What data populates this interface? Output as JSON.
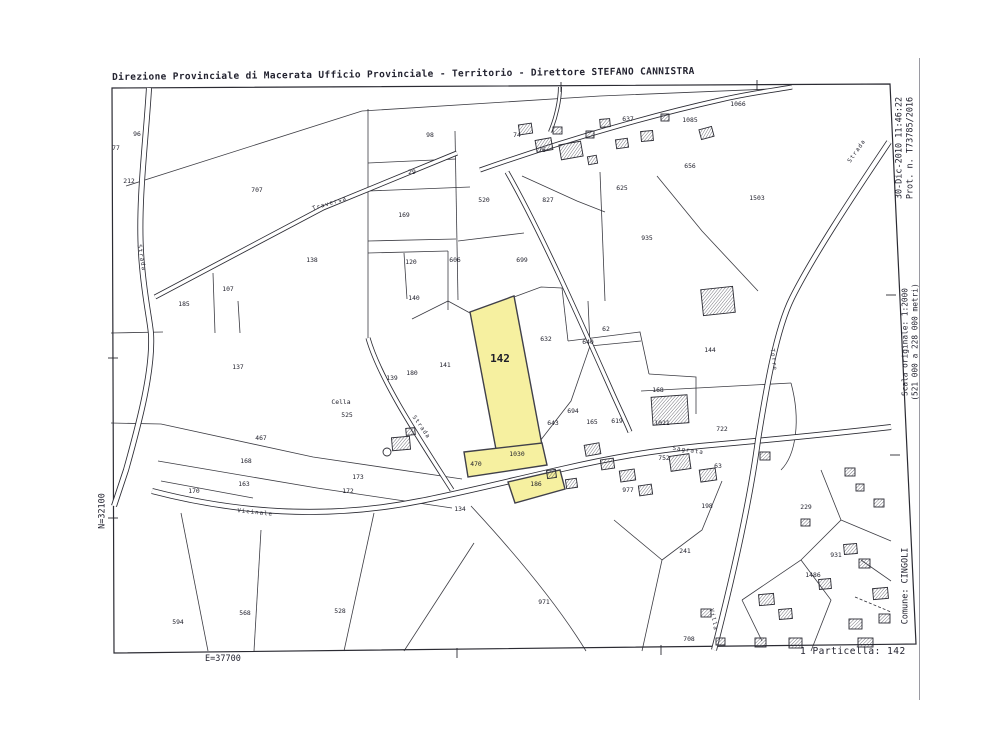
{
  "header": {
    "title": "Direzione Provinciale di Macerata  Ufficio Provinciale - Territorio - Direttore STEFANO CANNISTRA"
  },
  "margins": {
    "right_top_line1": "30-Dic-2010 11:46:22",
    "right_top_line2": "Prot. n. T73785/2016",
    "scale_line1": "Scala originale: 1:2000",
    "scale_line2": "(521 000 a 228 000 metri)",
    "comune": "Comune: CINGOLI",
    "north": "N=32100",
    "east": "E=37700",
    "particella": "1 Particella: 142"
  },
  "map": {
    "line_color": "#2b2b33",
    "highlight_color": "#f6f0a0",
    "highlight_stroke": "#40404a",
    "frame": [
      [
        112,
        88
      ],
      [
        890,
        84
      ],
      [
        916,
        644
      ],
      [
        114,
        653
      ]
    ],
    "highlights": [
      {
        "name": "parcel-142",
        "points": [
          [
            470,
            312
          ],
          [
            514,
            296
          ],
          [
            542,
            445
          ],
          [
            498,
            460
          ]
        ]
      },
      {
        "name": "parcel-1030",
        "points": [
          [
            464,
            452
          ],
          [
            542,
            443
          ],
          [
            547,
            465
          ],
          [
            468,
            477
          ]
        ]
      },
      {
        "name": "parcel-186",
        "points": [
          [
            508,
            482
          ],
          [
            560,
            470
          ],
          [
            565,
            489
          ],
          [
            515,
            503
          ]
        ]
      }
    ],
    "roads": [
      {
        "d": "M149,88 C146,140 138,200 141,252 C143,290 150,320 151,334 C153,370 140,420 126,470 L114,506",
        "w": 6
      },
      {
        "d": "M457,153 L323,208 L155,297",
        "w": 5
      },
      {
        "d": "M480,170 C560,142 640,118 720,100 C750,93 770,91 792,87",
        "w": 5
      },
      {
        "d": "M560,87 C560,100 556,118 550,132",
        "w": 4
      },
      {
        "d": "M368,338 C380,380 420,440 452,490",
        "w": 5
      },
      {
        "d": "M507,172 C540,230 580,320 612,392 C620,410 625,420 630,432",
        "w": 5
      },
      {
        "d": "M152,491 C240,514 330,519 420,501 C465,492 505,482 562,469 C610,458 650,451 700,446 C780,439 830,434 891,427",
        "w": 6
      },
      {
        "d": "M889,142 C850,200 812,258 792,298 C776,330 766,390 758,440 C750,500 732,580 714,650",
        "w": 6
      }
    ],
    "boundaries": [
      "M126,186 L362,111",
      "M362,111 L600,96 L770,89",
      "M368,109 L368,338",
      "M368,163 L456,159",
      "M368,191 L470,187",
      "M455,131 L458,300",
      "M368,241 L456,239",
      "M458,241 L524,233",
      "M213,273 L215,333",
      "M404,253 L407,299",
      "M368,253 L448,251",
      "M111,333 L163,332",
      "M111,423 L161,424",
      "M161,424 L313,457 L462,479",
      "M158,461 L317,488 L452,508",
      "M161,481 L253,498",
      "M181,513 L208,651",
      "M261,530 L254,651",
      "M374,513 L344,651",
      "M474,543 L404,651",
      "M471,506 C521,560 561,610 586,651",
      "M238,301 L240,333",
      "M412,319 L448,301",
      "M448,251 L448,310",
      "M448,301 L470,313",
      "M514,297 L541,287 L562,288",
      "M562,288 L568,341",
      "M540,441 L571,401 L590,346 L588,301",
      "M568,341 L640,332 L649,374",
      "M590,346 L641,341",
      "M600,172 L605,301",
      "M649,374 L696,377 L696,414",
      "M641,391 L791,383",
      "M791,383 C801,420 796,455 781,470",
      "M614,520 L662,560 L642,651",
      "M722,481 L702,530 L662,560",
      "M821,470 L841,520 L801,560 L742,600",
      "M841,520 L891,541",
      "M801,560 L831,600 L811,651",
      "M742,600 L762,641",
      "M861,560 L891,581",
      "M522,176 L577,201 L605,212",
      "M657,176 L702,231 L758,291"
    ],
    "dashed": [
      "M855,597 L891,612"
    ],
    "buildings": [
      [
        519,
        124,
        13,
        10,
        -8
      ],
      [
        536,
        139,
        16,
        12,
        -10
      ],
      [
        553,
        127,
        9,
        7,
        0
      ],
      [
        560,
        143,
        22,
        15,
        -10
      ],
      [
        586,
        131,
        8,
        7,
        0
      ],
      [
        600,
        119,
        10,
        8,
        -5
      ],
      [
        616,
        139,
        12,
        9,
        -8
      ],
      [
        641,
        131,
        12,
        10,
        -5
      ],
      [
        661,
        114,
        8,
        7,
        0
      ],
      [
        588,
        156,
        9,
        8,
        -10
      ],
      [
        700,
        128,
        13,
        10,
        -15
      ],
      [
        702,
        288,
        32,
        26,
        -6
      ],
      [
        652,
        396,
        36,
        28,
        -4
      ],
      [
        670,
        455,
        20,
        15,
        -8
      ],
      [
        700,
        469,
        16,
        12,
        -8
      ],
      [
        585,
        444,
        15,
        11,
        -10
      ],
      [
        601,
        459,
        13,
        10,
        -8
      ],
      [
        620,
        470,
        15,
        11,
        -8
      ],
      [
        639,
        485,
        13,
        10,
        -8
      ],
      [
        566,
        479,
        11,
        9,
        -8
      ],
      [
        547,
        470,
        9,
        8,
        -8
      ],
      [
        392,
        437,
        18,
        13,
        -5
      ],
      [
        406,
        428,
        9,
        7,
        -5
      ],
      [
        760,
        452,
        10,
        8,
        0
      ],
      [
        845,
        468,
        10,
        8,
        0
      ],
      [
        856,
        484,
        8,
        7,
        0
      ],
      [
        874,
        499,
        10,
        8,
        0
      ],
      [
        801,
        519,
        9,
        7,
        0
      ],
      [
        759,
        594,
        15,
        11,
        -5
      ],
      [
        779,
        609,
        13,
        10,
        -5
      ],
      [
        819,
        579,
        12,
        10,
        -5
      ],
      [
        844,
        544,
        13,
        10,
        -5
      ],
      [
        859,
        559,
        11,
        9,
        0
      ],
      [
        873,
        588,
        15,
        11,
        -5
      ],
      [
        849,
        619,
        13,
        10,
        0
      ],
      [
        879,
        614,
        11,
        9,
        0
      ],
      [
        755,
        638,
        11,
        9,
        0
      ],
      [
        789,
        638,
        13,
        10,
        0
      ],
      [
        701,
        609,
        10,
        8,
        0
      ],
      [
        716,
        638,
        9,
        7,
        0
      ],
      [
        858,
        638,
        15,
        9,
        0
      ]
    ],
    "wells": [
      [
        387,
        452,
        4
      ]
    ],
    "ticks": [
      [
        561,
        82,
        561,
        92
      ],
      [
        757,
        80,
        757,
        90
      ],
      [
        457,
        648,
        457,
        658
      ],
      [
        661,
        645,
        661,
        655
      ],
      [
        108,
        358,
        118,
        358
      ],
      [
        108,
        518,
        118,
        518
      ],
      [
        886,
        295,
        896,
        295
      ],
      [
        890,
        455,
        900,
        455
      ]
    ],
    "labels": [
      {
        "t": "77",
        "x": 116,
        "y": 150
      },
      {
        "t": "96",
        "x": 137,
        "y": 136
      },
      {
        "t": "212",
        "x": 129,
        "y": 183
      },
      {
        "t": "707",
        "x": 257,
        "y": 192
      },
      {
        "t": "98",
        "x": 430,
        "y": 137
      },
      {
        "t": "29",
        "x": 412,
        "y": 174
      },
      {
        "t": "169",
        "x": 404,
        "y": 217
      },
      {
        "t": "520",
        "x": 484,
        "y": 202
      },
      {
        "t": "138",
        "x": 312,
        "y": 262
      },
      {
        "t": "120",
        "x": 411,
        "y": 264
      },
      {
        "t": "606",
        "x": 455,
        "y": 262
      },
      {
        "t": "107",
        "x": 228,
        "y": 291
      },
      {
        "t": "185",
        "x": 184,
        "y": 306
      },
      {
        "t": "140",
        "x": 414,
        "y": 300
      },
      {
        "t": "74",
        "x": 517,
        "y": 137
      },
      {
        "t": "76",
        "x": 542,
        "y": 152
      },
      {
        "t": "637",
        "x": 628,
        "y": 121
      },
      {
        "t": "1085",
        "x": 690,
        "y": 122
      },
      {
        "t": "1066",
        "x": 738,
        "y": 106
      },
      {
        "t": "656",
        "x": 690,
        "y": 168
      },
      {
        "t": "1503",
        "x": 757,
        "y": 200
      },
      {
        "t": "625",
        "x": 622,
        "y": 190
      },
      {
        "t": "827",
        "x": 548,
        "y": 202
      },
      {
        "t": "935",
        "x": 647,
        "y": 240
      },
      {
        "t": "699",
        "x": 522,
        "y": 262
      },
      {
        "t": "137",
        "x": 238,
        "y": 369
      },
      {
        "t": "Cella",
        "x": 341,
        "y": 404
      },
      {
        "t": "525",
        "x": 347,
        "y": 417
      },
      {
        "t": "467",
        "x": 261,
        "y": 440
      },
      {
        "t": "168",
        "x": 246,
        "y": 463
      },
      {
        "t": "163",
        "x": 244,
        "y": 486
      },
      {
        "t": "170",
        "x": 194,
        "y": 493
      },
      {
        "t": "173",
        "x": 358,
        "y": 479
      },
      {
        "t": "172",
        "x": 348,
        "y": 493
      },
      {
        "t": "594",
        "x": 178,
        "y": 624
      },
      {
        "t": "568",
        "x": 245,
        "y": 615
      },
      {
        "t": "528",
        "x": 340,
        "y": 613
      },
      {
        "t": "134",
        "x": 460,
        "y": 511
      },
      {
        "t": "139",
        "x": 392,
        "y": 380
      },
      {
        "t": "180",
        "x": 412,
        "y": 375
      },
      {
        "t": "141",
        "x": 445,
        "y": 367
      },
      {
        "t": "470",
        "x": 476,
        "y": 466
      },
      {
        "t": "971",
        "x": 544,
        "y": 604
      },
      {
        "t": "142",
        "x": 500,
        "y": 362,
        "s": 11,
        "b": 1
      },
      {
        "t": "1030",
        "x": 517,
        "y": 456
      },
      {
        "t": "186",
        "x": 536,
        "y": 486
      },
      {
        "t": "632",
        "x": 546,
        "y": 341
      },
      {
        "t": "62",
        "x": 606,
        "y": 331
      },
      {
        "t": "640",
        "x": 588,
        "y": 344
      },
      {
        "t": "144",
        "x": 710,
        "y": 352
      },
      {
        "t": "168",
        "x": 658,
        "y": 392
      },
      {
        "t": "1021",
        "x": 662,
        "y": 425
      },
      {
        "t": "722",
        "x": 722,
        "y": 431
      },
      {
        "t": "694",
        "x": 573,
        "y": 413
      },
      {
        "t": "165",
        "x": 592,
        "y": 424
      },
      {
        "t": "643",
        "x": 553,
        "y": 425
      },
      {
        "t": "619",
        "x": 617,
        "y": 423
      },
      {
        "t": "977",
        "x": 628,
        "y": 492
      },
      {
        "t": "752",
        "x": 664,
        "y": 460
      },
      {
        "t": "63",
        "x": 718,
        "y": 468
      },
      {
        "t": "198",
        "x": 707,
        "y": 508
      },
      {
        "t": "229",
        "x": 806,
        "y": 509
      },
      {
        "t": "241",
        "x": 685,
        "y": 553
      },
      {
        "t": "1486",
        "x": 813,
        "y": 577
      },
      {
        "t": "708",
        "x": 689,
        "y": 641
      },
      {
        "t": "931",
        "x": 836,
        "y": 557
      }
    ],
    "road_labels": [
      {
        "t": "Strada",
        "x": 140,
        "y": 258,
        "r": 80
      },
      {
        "t": "Traversa",
        "x": 330,
        "y": 205,
        "r": -17
      },
      {
        "t": "Strada",
        "x": 420,
        "y": 428,
        "r": 55
      },
      {
        "t": "Sagrata",
        "x": 688,
        "y": 452,
        "r": 8
      },
      {
        "t": "Vicinale",
        "x": 255,
        "y": 514,
        "r": 6
      },
      {
        "t": "Torre",
        "x": 772,
        "y": 360,
        "r": 83
      },
      {
        "t": "Villa",
        "x": 712,
        "y": 620,
        "r": 78
      },
      {
        "t": "Strada",
        "x": 858,
        "y": 152,
        "r": -55
      }
    ]
  }
}
